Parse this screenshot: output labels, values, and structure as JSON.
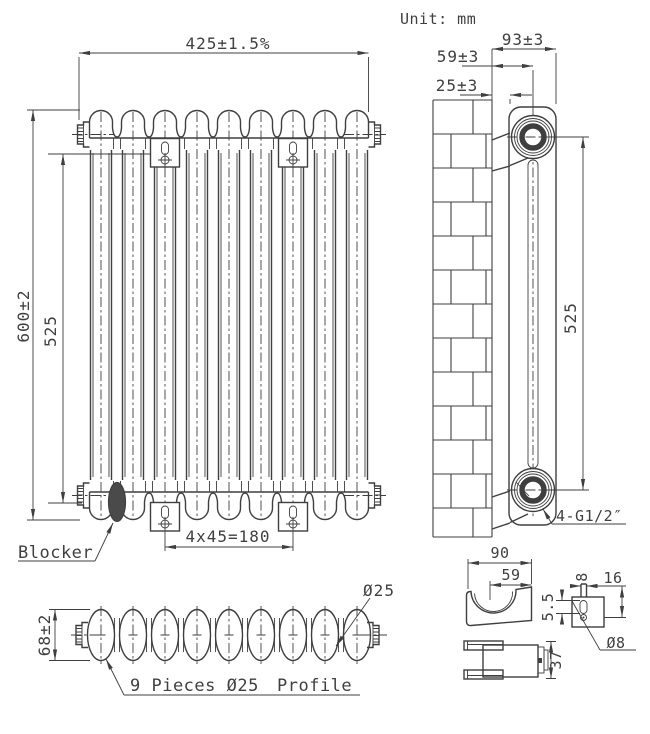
{
  "unit_note": "Unit: mm",
  "front_view": {
    "sections": 9,
    "width_dim": "425±1.5%",
    "height_dim": "600±2",
    "mount_height_dim": "525",
    "bracket_spacing_dim": "4x45=180",
    "blocker_label": "Blocker"
  },
  "side_view": {
    "depth_dim": "93±3",
    "center_dim": "59±3",
    "wall_gap_dim": "25±3",
    "port_spacing_dim": "525",
    "connection_label": "4-G1/2″"
  },
  "profile_view": {
    "height_dim": "68±2",
    "tube_dia_dim": "Ø25",
    "pieces_label": "9 Pieces Ø25",
    "profile_label": "Profile"
  },
  "bracket_detail": {
    "width_dim": "90",
    "hook_dim": "59",
    "pin_dia_dim": "8",
    "offset_dim": "16",
    "slot_dim": "5.5",
    "hole_dia_dim": "Ø8",
    "depth_dim": "37"
  },
  "colors": {
    "line": "#3f3f3f",
    "background": "#ffffff"
  }
}
